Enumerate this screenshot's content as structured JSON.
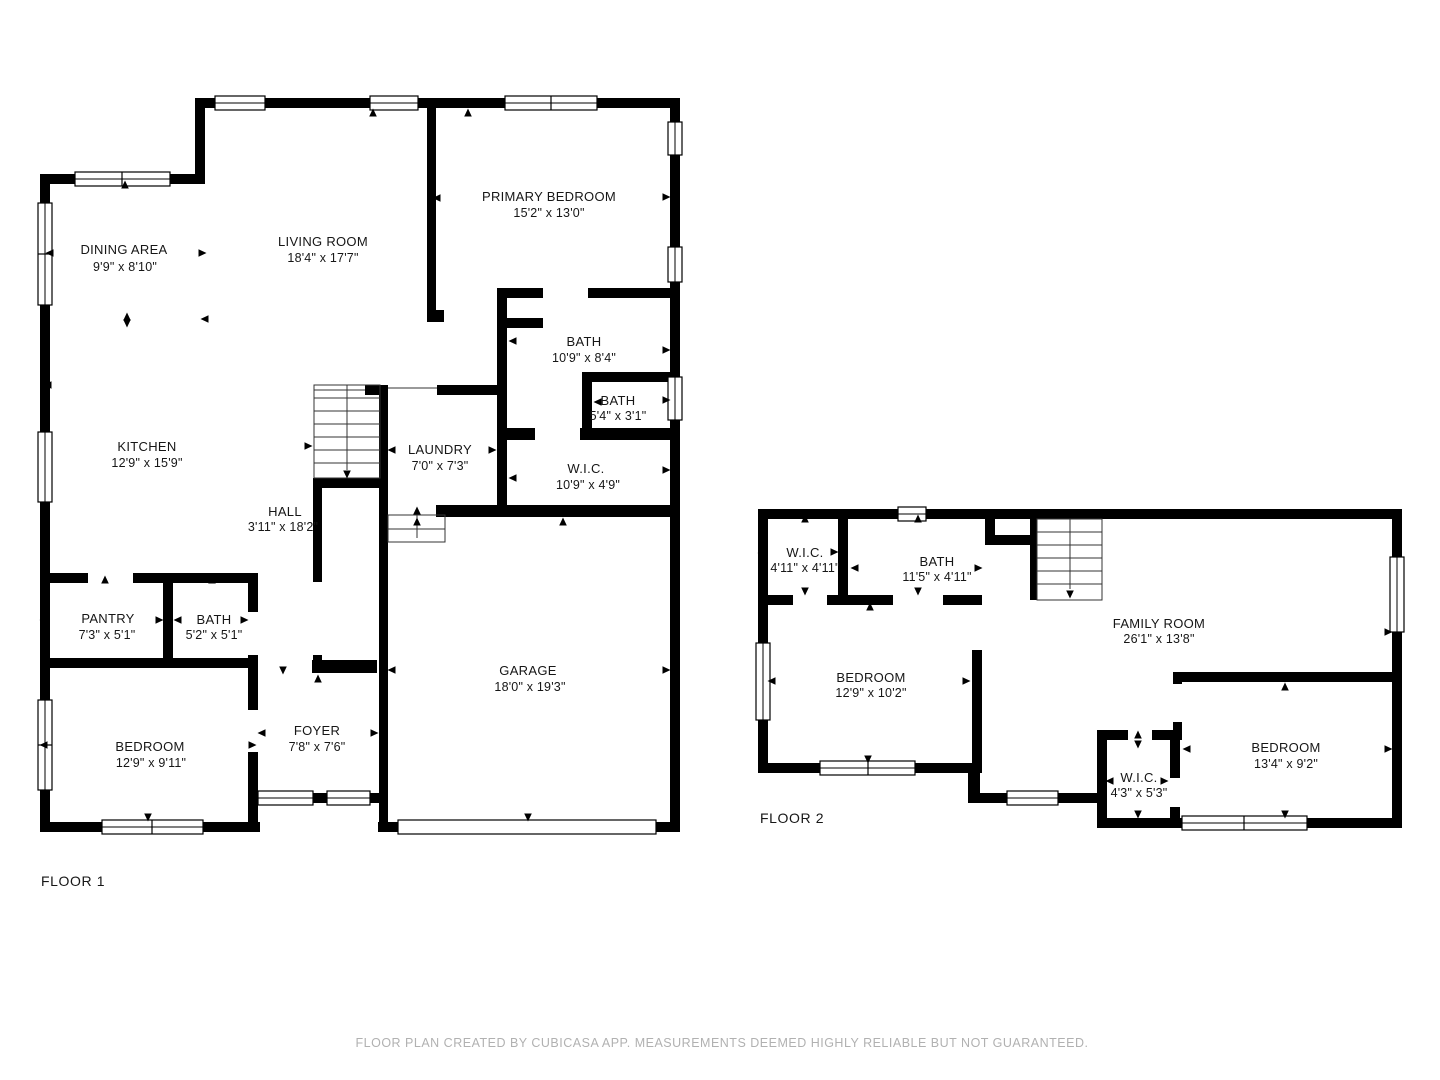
{
  "title": "Floor plan",
  "floors": [
    {
      "label": "FLOOR 1",
      "rooms": [
        {
          "name": "DINING AREA",
          "dims": "9'9\" x 8'10\""
        },
        {
          "name": "LIVING ROOM",
          "dims": "18'4\" x 17'7\""
        },
        {
          "name": "PRIMARY BEDROOM",
          "dims": "15'2\" x 13'0\""
        },
        {
          "name": "BATH",
          "dims": "10'9\" x 8'4\""
        },
        {
          "name": "BATH",
          "dims": "5'4\" x 3'1\""
        },
        {
          "name": "W.I.C.",
          "dims": "10'9\" x 4'9\""
        },
        {
          "name": "LAUNDRY",
          "dims": "7'0\" x 7'3\""
        },
        {
          "name": "KITCHEN",
          "dims": "12'9\" x 15'9\""
        },
        {
          "name": "HALL",
          "dims": "3'11\" x 18'2\""
        },
        {
          "name": "PANTRY",
          "dims": "7'3\" x 5'1\""
        },
        {
          "name": "BATH",
          "dims": "5'2\" x 5'1\""
        },
        {
          "name": "BEDROOM",
          "dims": "12'9\" x 9'11\""
        },
        {
          "name": "FOYER",
          "dims": "7'8\" x 7'6\""
        },
        {
          "name": "GARAGE",
          "dims": "18'0\" x 19'3\""
        }
      ]
    },
    {
      "label": "FLOOR 2",
      "rooms": [
        {
          "name": "W.I.C.",
          "dims": "4'11\" x 4'11\""
        },
        {
          "name": "BATH",
          "dims": "11'5\" x 4'11\""
        },
        {
          "name": "FAMILY ROOM",
          "dims": "26'1\" x 13'8\""
        },
        {
          "name": "BEDROOM",
          "dims": "12'9\" x 10'2\""
        },
        {
          "name": "BEDROOM",
          "dims": "13'4\" x 9'2\""
        },
        {
          "name": "W.I.C.",
          "dims": "4'3\" x 5'3\""
        }
      ]
    }
  ],
  "footer": "FLOOR PLAN CREATED BY CUBICASA APP. MEASUREMENTS DEEMED HIGHLY RELIABLE BUT NOT GUARANTEED.",
  "colors": {
    "wall": "#000000",
    "background": "#ffffff",
    "room_text": "#161616",
    "footer_text": "#b1b1b1"
  }
}
